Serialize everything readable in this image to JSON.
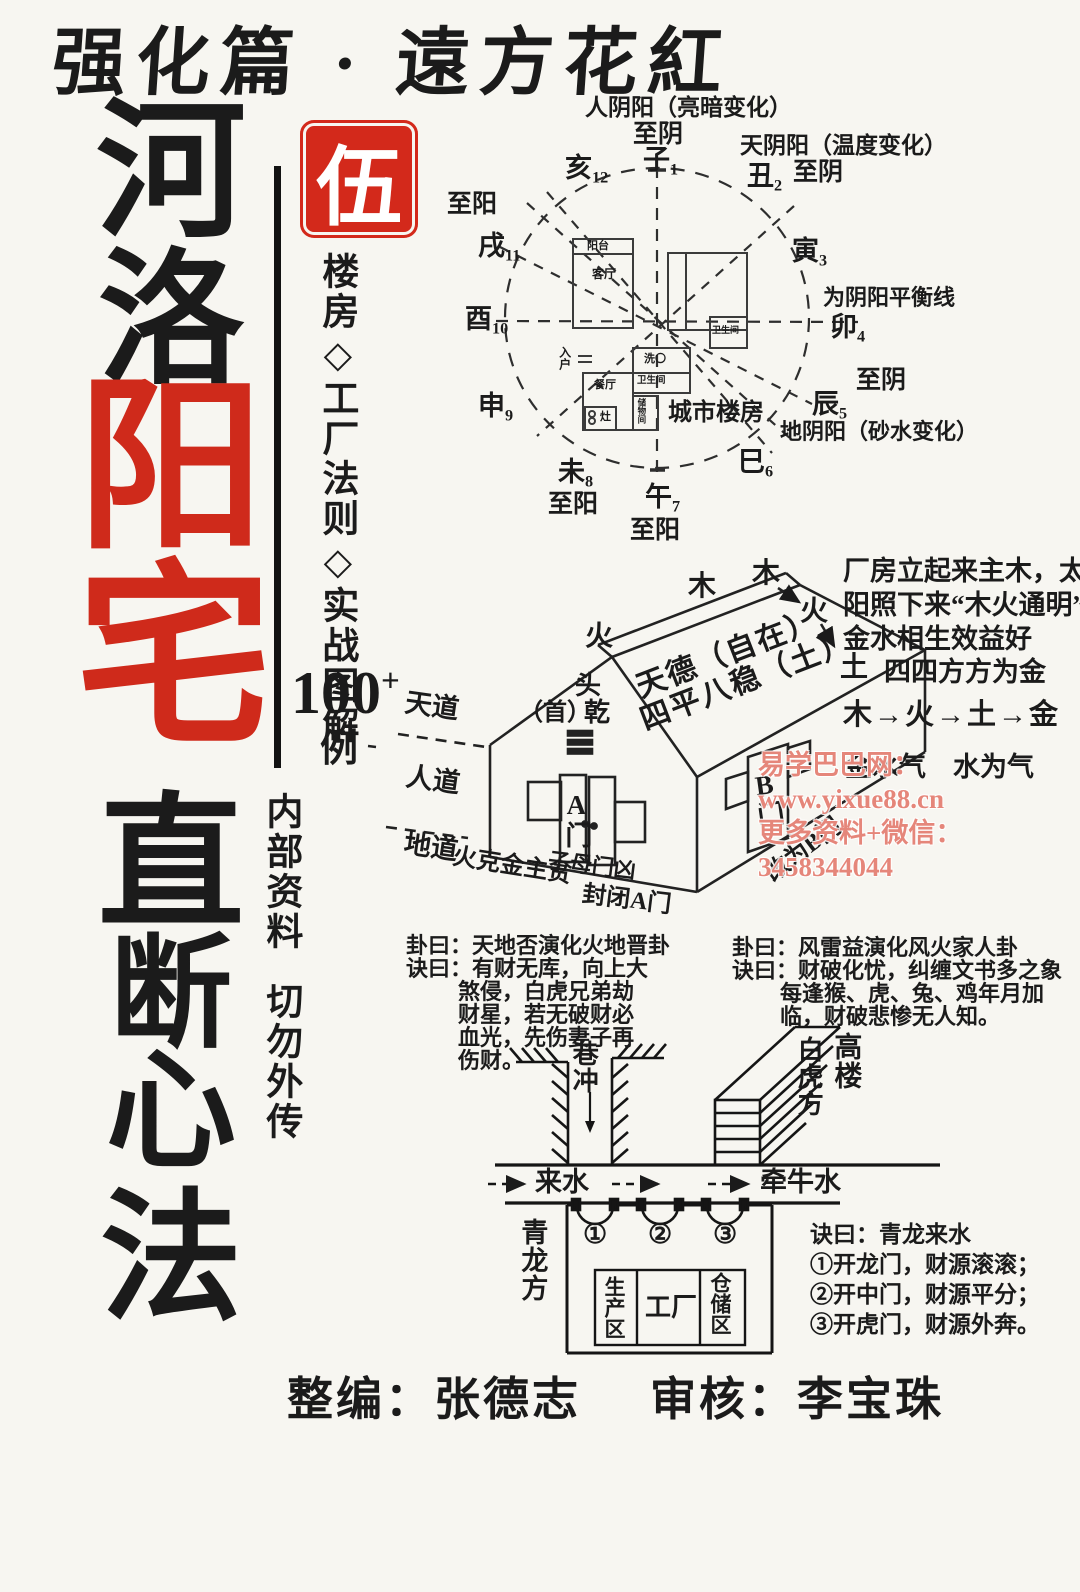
{
  "colors": {
    "red": "#cf2a1b",
    "ink": "#1b1b1b",
    "watermark": "#e5867a"
  },
  "header": {
    "text": "强化篇 · 遠方花紅"
  },
  "title": {
    "chars": [
      "河",
      "洛",
      "阳",
      "宅",
      "直",
      "断",
      "心",
      "法"
    ]
  },
  "seal": {
    "char": "伍"
  },
  "subtitle": {
    "vertical": "楼房◇工厂法则◇实战图解",
    "count": "100",
    "plus": "+",
    "tail": "例"
  },
  "confidential": {
    "line1": "内部资料",
    "line2": "切勿外传"
  },
  "compass": {
    "note_people": "人阴阳（亮暗变化）",
    "note_sky": "天阴阳（温度变化）",
    "note_earth": "地阴阳（砂水变化）",
    "note_balance": "为阴阳平衡线",
    "zhiyin_top": "至阴",
    "zhiyin_ne": "至阴",
    "zhiyin_e": "至阴",
    "zhiyang_w": "至阳",
    "zhiyang_sw": "至阳",
    "zhiyang_s": "至阳",
    "branches": [
      {
        "n": "子",
        "i": "1"
      },
      {
        "n": "丑",
        "i": "2"
      },
      {
        "n": "寅",
        "i": "3"
      },
      {
        "n": "卯",
        "i": "4"
      },
      {
        "n": "辰",
        "i": "5"
      },
      {
        "n": "巳",
        "i": "6"
      },
      {
        "n": "午",
        "i": "7"
      },
      {
        "n": "未",
        "i": "8"
      },
      {
        "n": "申",
        "i": "9"
      },
      {
        "n": "酉",
        "i": "10"
      },
      {
        "n": "戌",
        "i": "11"
      },
      {
        "n": "亥",
        "i": "12"
      }
    ],
    "floorplan": {
      "balcony": "阳台",
      "living": "客厅",
      "bath1": "卫生间",
      "wash": "洗〇",
      "bath2": "卫生间",
      "dining": "餐厅",
      "stove": "灶",
      "storage": "储物间",
      "entry": "入户",
      "caption": "城市楼房"
    }
  },
  "house": {
    "roof_line1": "天德（自在）",
    "roof_line2": "四平八稳（土）",
    "head_top": "头",
    "head_shou": "（首）",
    "head_qian": "乾",
    "wood1": "木",
    "wood2": "木",
    "fire1": "火",
    "fire2": "火",
    "earth": "土",
    "door_a": "A门",
    "door_b": "B门",
    "tian": "天道",
    "ren": "人道",
    "di": "地道",
    "note_fire": "火克金主贫",
    "note_zimu": "子母门凶",
    "note_close": "封闭A门",
    "note_change": "改为B门",
    "note_right1": "厂房立起来主木，太",
    "note_right2": "阳照下来“木火通明”",
    "note_right3": "金水相生效益好",
    "note_square": "四四方方为金",
    "note_cycle": "木→火→土→金",
    "note_hidden": "金水气　水为气"
  },
  "gua_left": {
    "l1": "卦曰：天地否演化火地晋卦",
    "l2": "诀曰：有财无库，向上大",
    "l3": "煞侵，白虎兄弟劫",
    "l4": "财星，若无破财必",
    "l5": "血光，先伤妻子再",
    "l6": "伤财。"
  },
  "gua_right": {
    "l1": "卦曰：风雷益演化风火家人卦",
    "l2": "诀曰：财破化忧，纠缠文书多之象",
    "l3": "每逢猴、虎、兔、鸡年月加",
    "l4": "临，财破悲惨无人知。"
  },
  "bottom": {
    "alley": "巷冲",
    "white_tiger": "白虎方",
    "tall_building": "高楼",
    "incoming_water": "来水",
    "leading_water": "牵牛水",
    "green_dragon": "青龙方",
    "door1": "①",
    "door2": "②",
    "door3": "③",
    "room_prod": "生产区",
    "room_factory": "工厂",
    "room_store": "仓储区",
    "verse_title": "诀曰：青龙来水",
    "verse1": "①开龙门，财源滚滚；",
    "verse2": "②开中门，财源平分；",
    "verse3": "③开虎门，财源外奔。"
  },
  "credits": {
    "editor": "整编：张德志",
    "reviewer": "审核：李宝珠"
  },
  "watermark": {
    "line1": "易学巴巴网：www.yixue88.cn",
    "line2": "更多资料+微信：3458344044"
  }
}
